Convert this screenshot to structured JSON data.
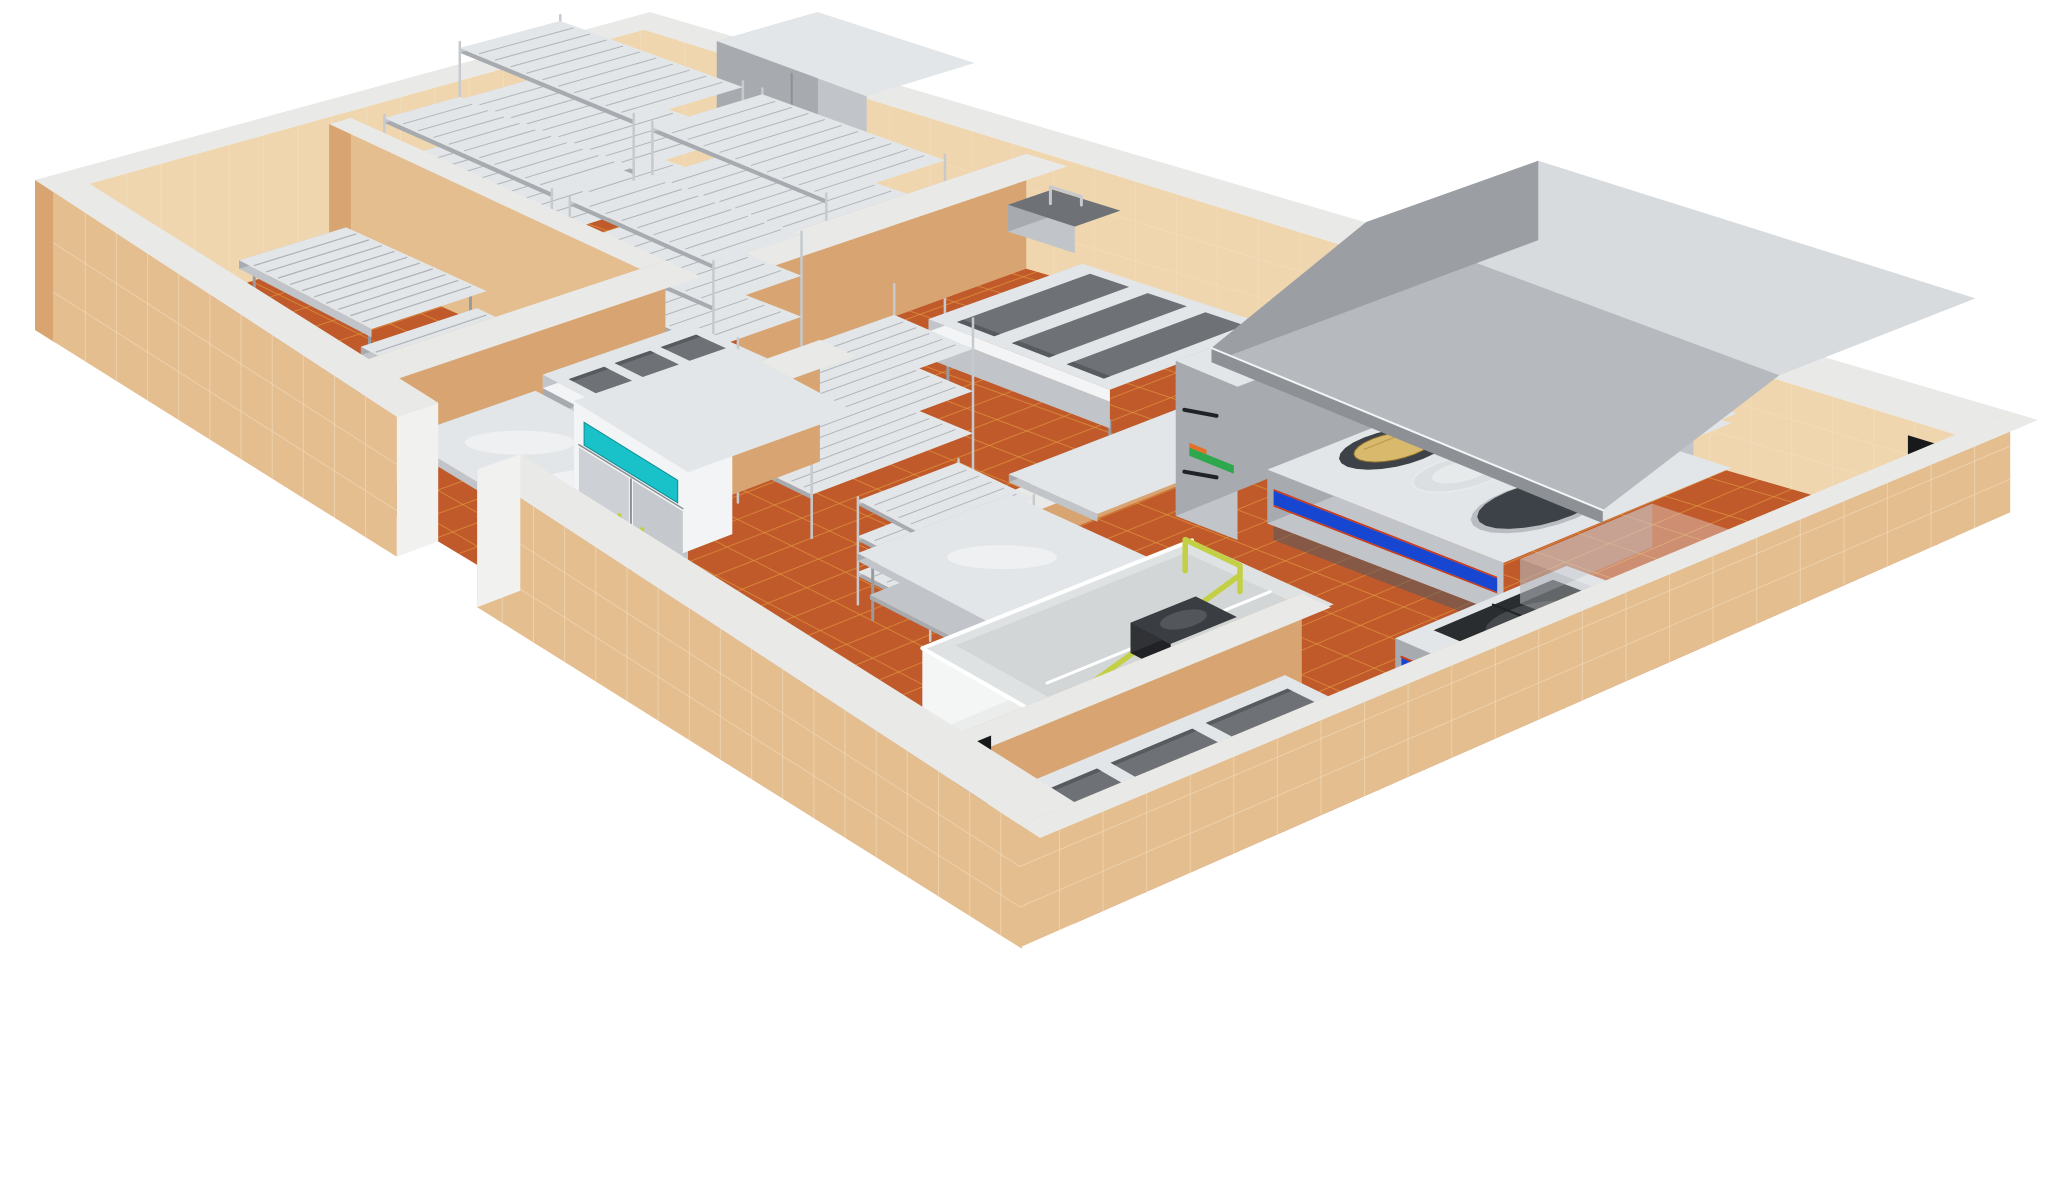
{
  "scene": {
    "description": "Perspective 3D cutaway render of a commercial kitchen floor plan on a white background: tan tiled cutaway walls, terracotta tile floors, stainless-steel equipment",
    "background": "#ffffff",
    "view": "elevated perspective, cutaway walls"
  },
  "palette": {
    "background": "#ffffff",
    "floor_tile": "#C05A2B",
    "floor_grout": "#E29A3F",
    "wall_tile": "#E5BE90",
    "wall_tile_light": "#F0D6AE",
    "wall_tile_shade": "#D8A572",
    "wall_grout": "#F4E3C6",
    "wall_cap": "#E9E9E7",
    "wall_end": "#F1F1EF",
    "steel_top": "#E3E6E8",
    "steel_front": "#C1C5C9",
    "steel_side": "#A7ABB0",
    "steel_bright": "#F2F4F5",
    "steel_dark": "#8D9195",
    "chrome": "#C6CACE",
    "leg": "#989CA1",
    "basin": "#6E7276",
    "basin_deep": "#575B5F",
    "accent_teal": "#19C2C9",
    "accent_green": "#C3D045",
    "accent_blue": "#1747D0",
    "accent_red": "#CC3A1A",
    "griddle": "#3C4247",
    "wok_tan": "#D9BA6C",
    "glass": "#D5DADD",
    "hood_top": "#D8DBDE",
    "hood_front": "#B6BABE",
    "hood_side": "#9B9FA4",
    "white_unit": "#EBEDED",
    "black": "#202225",
    "shadow": "#17191B",
    "label_green": "#2EA84C",
    "label_orange": "#E2702A"
  },
  "rooms": [
    {
      "id": "storage-room",
      "name": "dry storage room with wire shelving"
    },
    {
      "id": "drying-room",
      "name": "west room with slatted benches"
    },
    {
      "id": "prep-room",
      "name": "preparation room with tables and sink"
    },
    {
      "id": "center-corridor",
      "name": "central corridor with refrigerator"
    },
    {
      "id": "cooking-line",
      "name": "cooking line under exhaust hood"
    },
    {
      "id": "washing-area",
      "name": "front washing area with pot sink"
    }
  ],
  "equipment": [
    {
      "id": "tiled-floor",
      "name": "terracotta tile floor",
      "color": "#C05A2B"
    },
    {
      "id": "outer-wall-northwest",
      "name": "tiled outer wall (back left)"
    },
    {
      "id": "outer-wall-northeast",
      "name": "tiled outer wall (back right)"
    },
    {
      "id": "outer-wall-southwest",
      "name": "tiled outer wall (front left, with opening)"
    },
    {
      "id": "outer-wall-southeast",
      "name": "tiled outer wall (front right)"
    },
    {
      "id": "partition-wall",
      "name": "interior tiled partition wall with white cap"
    },
    {
      "id": "doorway-opening",
      "name": "dark doorway opening"
    },
    {
      "id": "storage-cabinet",
      "name": "tall stainless two-door storage cabinet"
    },
    {
      "id": "wire-shelving-rack",
      "name": "chrome wire shelving rack",
      "count": 6
    },
    {
      "id": "slatted-bench",
      "name": "low stainless slatted bench",
      "count": 2
    },
    {
      "id": "hand-wash-sink",
      "name": "wall hand wash sink with gooseneck faucet"
    },
    {
      "id": "prep-sink",
      "name": "three-compartment prep sink"
    },
    {
      "id": "wash-sink",
      "name": "three-compartment wash sink"
    },
    {
      "id": "pot-sink",
      "name": "three-compartment pot sink"
    },
    {
      "id": "prep-table",
      "name": "stainless work table",
      "count": 2
    },
    {
      "id": "base-counter",
      "name": "stainless base counter"
    },
    {
      "id": "wall-counter",
      "name": "L-shaped counter on half wall"
    },
    {
      "id": "upright-refrigerator",
      "name": "double-door upright refrigerator",
      "accents": [
        "#19C2C9",
        "#C3D045"
      ]
    },
    {
      "id": "exhaust-hood",
      "name": "large stainless exhaust canopy hood"
    },
    {
      "id": "wok-range",
      "name": "wok range with blue trim band",
      "accents": [
        "#1747D0",
        "#CC3A1A"
      ]
    },
    {
      "id": "wok-pan",
      "name": "tan wok on burner ring",
      "color": "#D9BA6C"
    },
    {
      "id": "glass-wok",
      "name": "glass wok on cooktop"
    },
    {
      "id": "griddle-plate",
      "name": "round dark griddle plate",
      "color": "#3C4247"
    },
    {
      "id": "tall-oven-cabinet",
      "name": "tall stainless oven cabinet with handles"
    },
    {
      "id": "back-storage-unit",
      "name": "back shelf unit with stocked items"
    },
    {
      "id": "soak-sink-station",
      "name": "white soak sink station"
    },
    {
      "id": "rinse-pipe",
      "name": "yellow-green rinse pipe",
      "color": "#C3D045"
    },
    {
      "id": "pump-unit",
      "name": "black pump unit"
    },
    {
      "id": "stockpot-stove",
      "name": "low stockpot stove with cast grate",
      "accents": [
        "#1747D0"
      ]
    },
    {
      "id": "stockpot-stove-ghost",
      "name": "faint secondary stove"
    }
  ]
}
